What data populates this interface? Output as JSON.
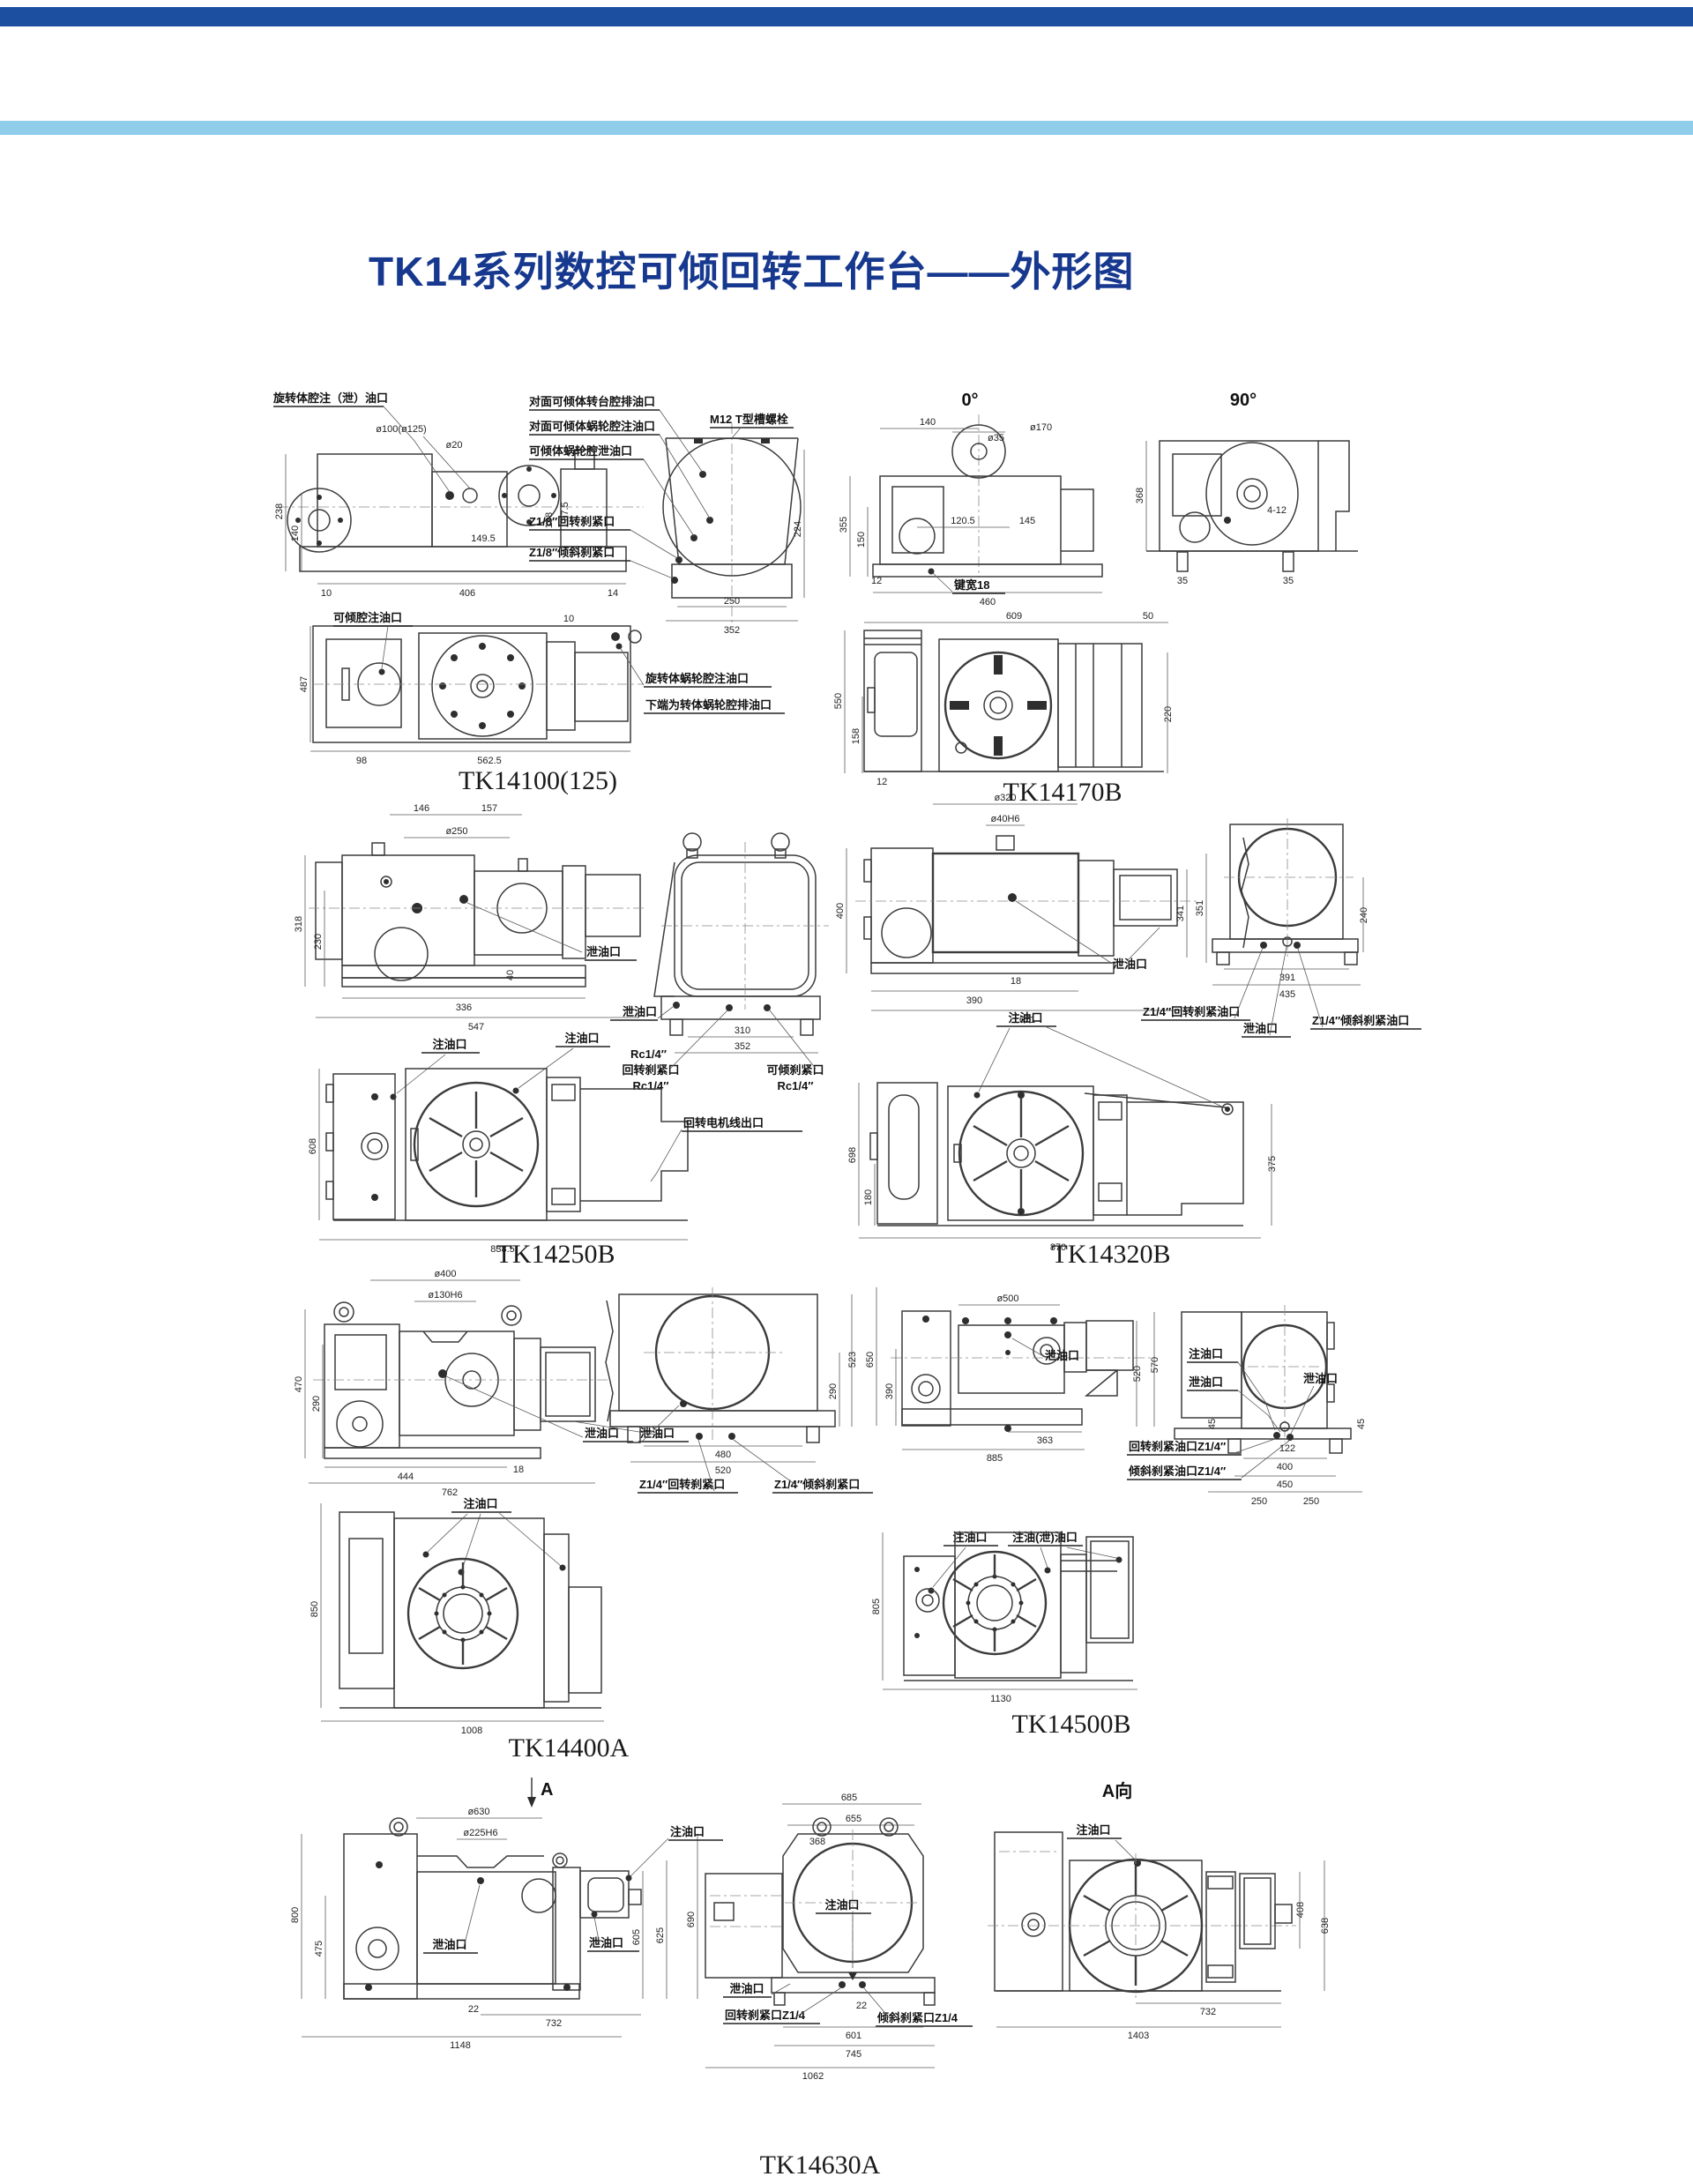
{
  "page": {
    "title": "TK14系列数控可倾回转工作台——外形图",
    "colors": {
      "top_bar": "#1d4fa1",
      "stripe": "#8fcdeb",
      "title": "#16388e",
      "line": "#3c3c3c"
    }
  },
  "drawings": [
    {
      "label": "TK14100(125)",
      "call": [
        "旋转体腔注（泄）油口",
        "对面可倾体转台腔排油口",
        "对面可倾体蜗轮腔注油口",
        "可倾体蜗轮腔泄油口",
        "M12 T型槽螺栓",
        "Z1/8″回转刹紧口",
        "Z1/8″倾斜刹紧口",
        "可倾腔注油口",
        "旋转体蜗轮腔注油口",
        "下端为转体蜗轮腔排油口"
      ],
      "dims": [
        "ø100(ø125)",
        "ø20",
        "238",
        "140",
        "10",
        "406",
        "14",
        "149.5",
        "198",
        "37.5",
        "250",
        "352",
        "224",
        "487",
        "98",
        "562.5",
        "10"
      ]
    },
    {
      "label": "TK14170B",
      "views": [
        "0°",
        "90°"
      ],
      "call": [
        "键宽18",
        "4-12"
      ],
      "dims": [
        "140",
        "ø170",
        "ø35",
        "355",
        "150",
        "120.5",
        "145",
        "12",
        "460",
        "368",
        "35",
        "609",
        "50",
        "550",
        "158",
        "12",
        "220"
      ]
    },
    {
      "label": "TK14250B",
      "call": [
        "泄油口",
        "泄油口",
        "回转刹紧口",
        "Rc1/4″",
        "可倾刹紧口",
        "Rc1/4″",
        "注油口",
        "注油口",
        "Rc1/4″",
        "回转电机线出口"
      ],
      "dims": [
        "146",
        "157",
        "ø250",
        "318",
        "230",
        "336",
        "547",
        "40",
        "310",
        "352",
        "608",
        "838.5"
      ]
    },
    {
      "label": "TK14320B",
      "call": [
        "泄油口",
        "注油口",
        "Z1/4″回转刹紧油口",
        "泄油口",
        "Z1/4″倾斜刹紧油口"
      ],
      "dims": [
        "ø320",
        "ø40H6",
        "400",
        "341",
        "351",
        "18",
        "390",
        "671",
        "240",
        "391",
        "435",
        "698",
        "180",
        "870",
        "375"
      ]
    },
    {
      "label": "TK14400A",
      "call": [
        "泄油口",
        "泄油口",
        "注油口",
        "Z1/4″回转刹紧口",
        "Z1/4″倾斜刹紧口"
      ],
      "dims": [
        "ø400",
        "ø130H6",
        "470",
        "290",
        "444",
        "18",
        "762",
        "523",
        "290",
        "480",
        "520",
        "850",
        "1008"
      ]
    },
    {
      "label": "TK14500B",
      "call": [
        "泄油口",
        "注油口",
        "泄油口",
        "回转刹紧油口Z1/4″",
        "倾斜刹紧油口Z1/4″",
        "泄油口",
        "注油口",
        "注油(泄)油口"
      ],
      "dims": [
        "ø500",
        "650",
        "390",
        "363",
        "885",
        "520",
        "570",
        "45",
        "45",
        "122",
        "400",
        "450",
        "250",
        "250",
        "805",
        "1130"
      ]
    },
    {
      "label": "TK14630A",
      "views": [
        "A",
        "A向"
      ],
      "call": [
        "注油口",
        "泄油口",
        "泄油口",
        "注油口",
        "泄油口",
        "回转刹紧口Z1/4",
        "倾斜刹紧口Z1/4",
        "注油口"
      ],
      "dims": [
        "ø630",
        "ø225H6",
        "800",
        "475",
        "605",
        "625",
        "690",
        "22",
        "732",
        "1148",
        "685",
        "655",
        "368",
        "22",
        "601",
        "745",
        "1062",
        "408",
        "638",
        "732",
        "1403"
      ]
    }
  ]
}
